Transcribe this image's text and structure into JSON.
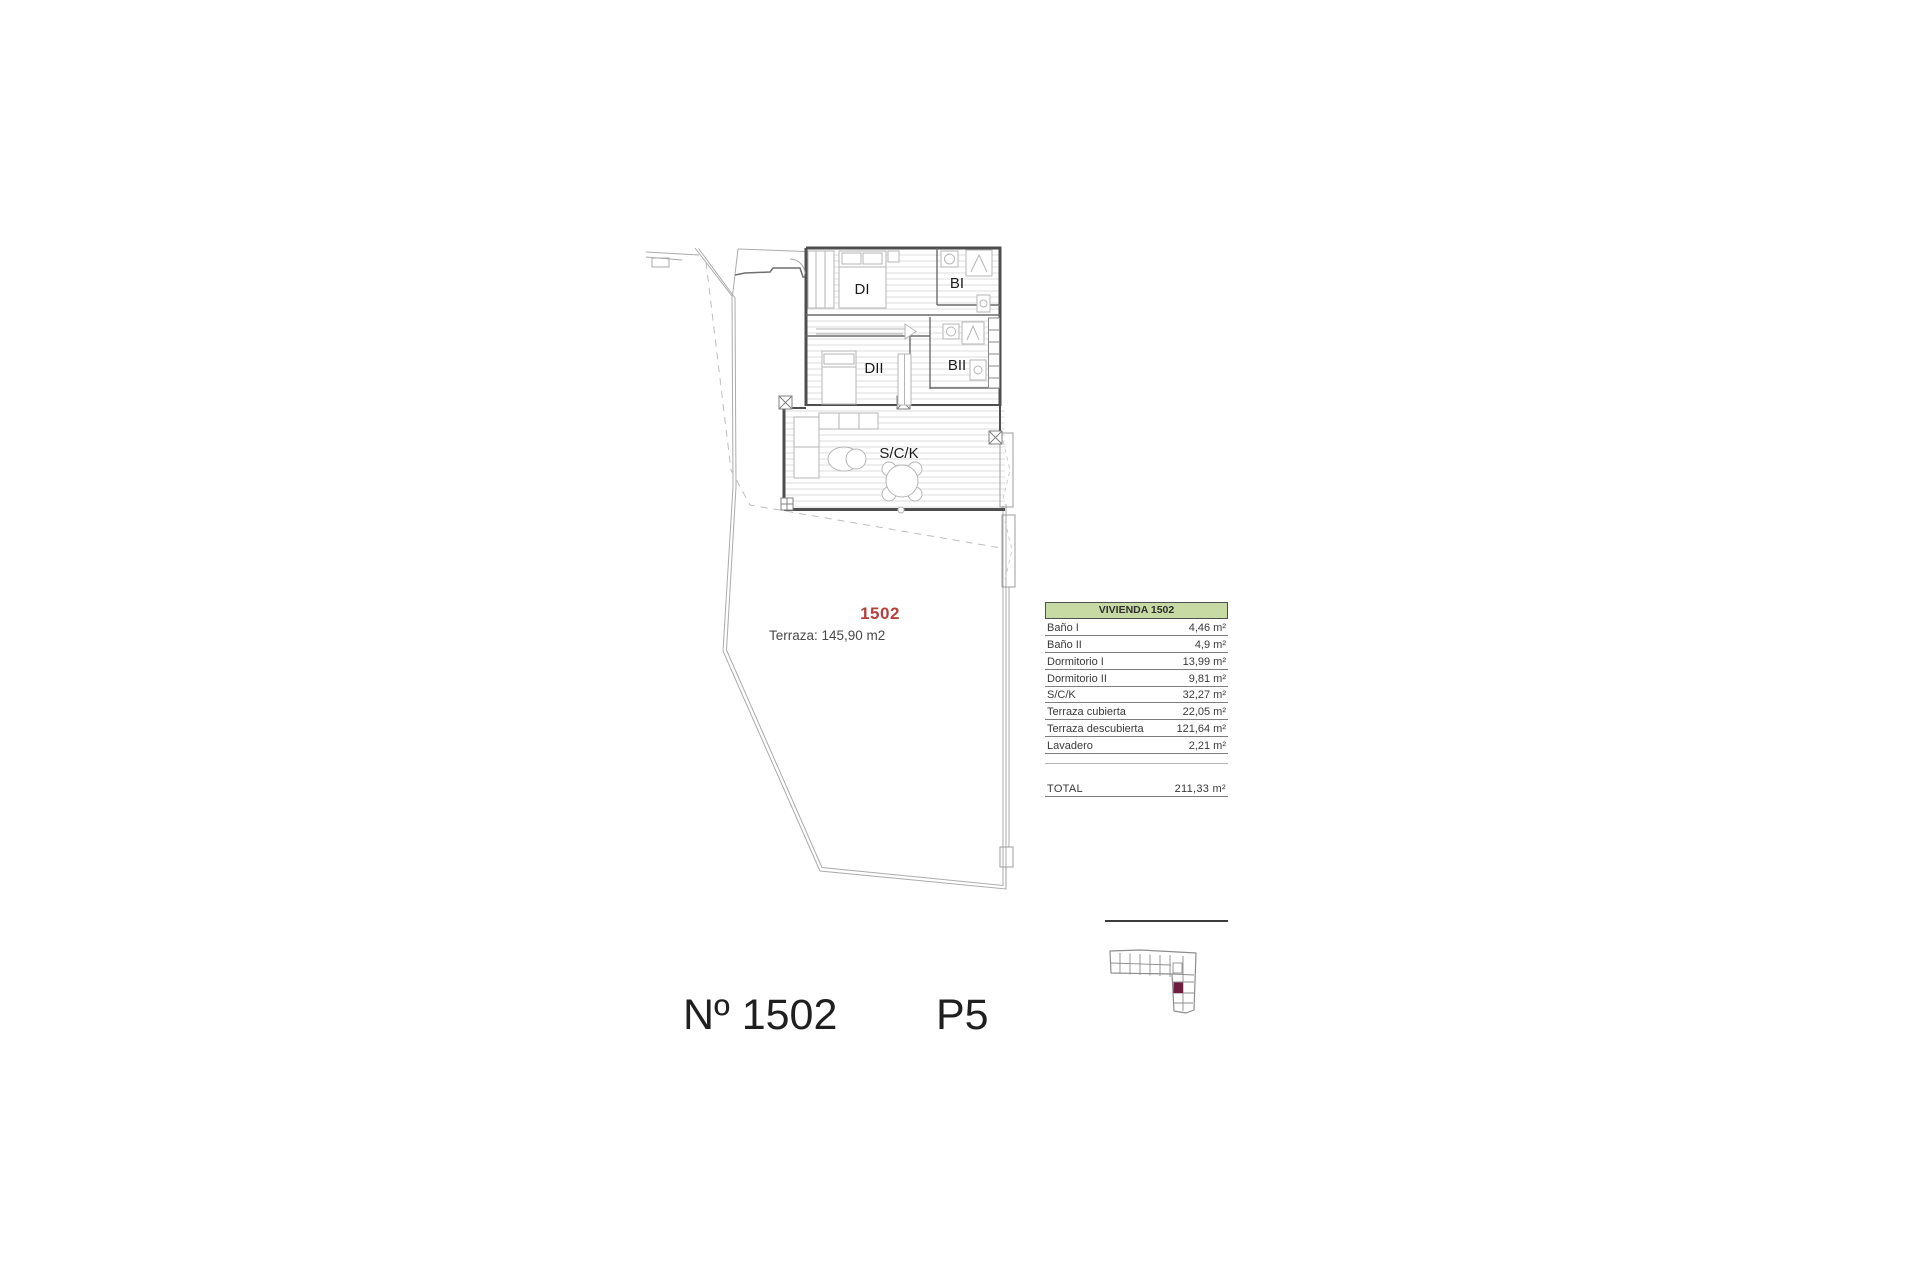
{
  "plan": {
    "room_labels": {
      "dormitorio1": "DI",
      "bano1": "BI",
      "dormitorio2": "DII",
      "bano2": "BII",
      "salon": "S/C/K"
    },
    "unit_number": "1502",
    "terrace_note": "Terraza: 145,90 m2",
    "colors": {
      "unit_number_red": "#b5413c",
      "table_header_green": "#c7daa4",
      "keyplan_highlight_maroon": "#6e1c40"
    }
  },
  "area_table": {
    "header": "VIVIENDA 1502",
    "rows": [
      {
        "label": "Baño I",
        "value": "4,46 m²"
      },
      {
        "label": "Baño II",
        "value": "4,9 m²"
      },
      {
        "label": "Dormitorio I",
        "value": "13,99 m²"
      },
      {
        "label": "Dormitorio II",
        "value": "9,81 m²"
      },
      {
        "label": "S/C/K",
        "value": "32,27 m²"
      },
      {
        "label": "Terraza cubierta",
        "value": "22,05 m²"
      },
      {
        "label": "Terraza descubierta",
        "value": "121,64 m²"
      },
      {
        "label": "Lavadero",
        "value": "2,21 m²"
      }
    ],
    "total": {
      "label": "TOTAL",
      "value": "211,33 m²"
    }
  },
  "footer": {
    "unit_label": "Nº 1502",
    "floor_label": "P5"
  }
}
